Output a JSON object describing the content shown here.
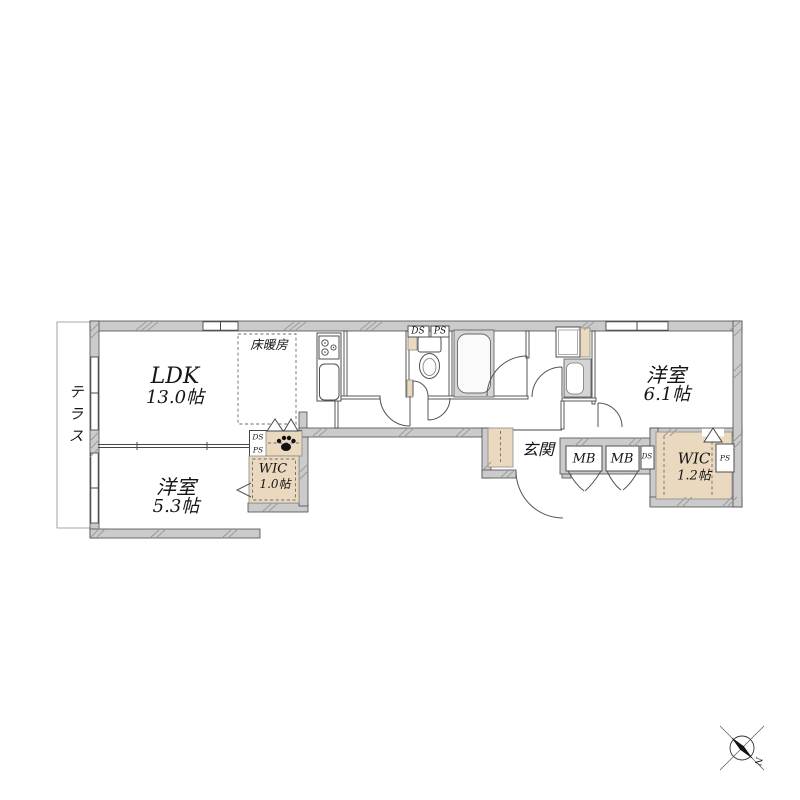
{
  "plan": {
    "rooms": {
      "ldk": {
        "name": "LDK",
        "size": "13.0帖"
      },
      "bedroom_a": {
        "name": "洋室",
        "size": "5.3帖"
      },
      "bedroom_b": {
        "name": "洋室",
        "size": "6.1帖"
      },
      "wic_a": {
        "name": "WIC",
        "size": "1.0帖"
      },
      "wic_b": {
        "name": "WIC",
        "size": "1.2帖"
      },
      "entrance": {
        "name": "玄関"
      },
      "terrace": {
        "name": "テラス"
      },
      "floor_heating": {
        "name": "床暖房"
      }
    },
    "shafts": {
      "toilet_ds": "DS",
      "toilet_ps": "PS",
      "wic_a_ds": "DS",
      "wic_a_ps": "PS",
      "meter_box_1": "MB",
      "meter_box_2": "MB",
      "meter_ds": "DS",
      "wic_b_ps": "PS"
    },
    "compass": {
      "north": "N"
    },
    "icons": {
      "paw": "paw-icon",
      "compass": "compass-north-icon",
      "stove": "stove-burners-icon",
      "toilet": "toilet-icon",
      "bathtub": "bathtub-icon"
    },
    "colors": {
      "wall_fill": "#cbcbcb",
      "wall_line": "#4a4a4a",
      "accent_beige": "#ead9bf",
      "fixture_gray": "#d4d4d4",
      "text": "#141414"
    }
  }
}
